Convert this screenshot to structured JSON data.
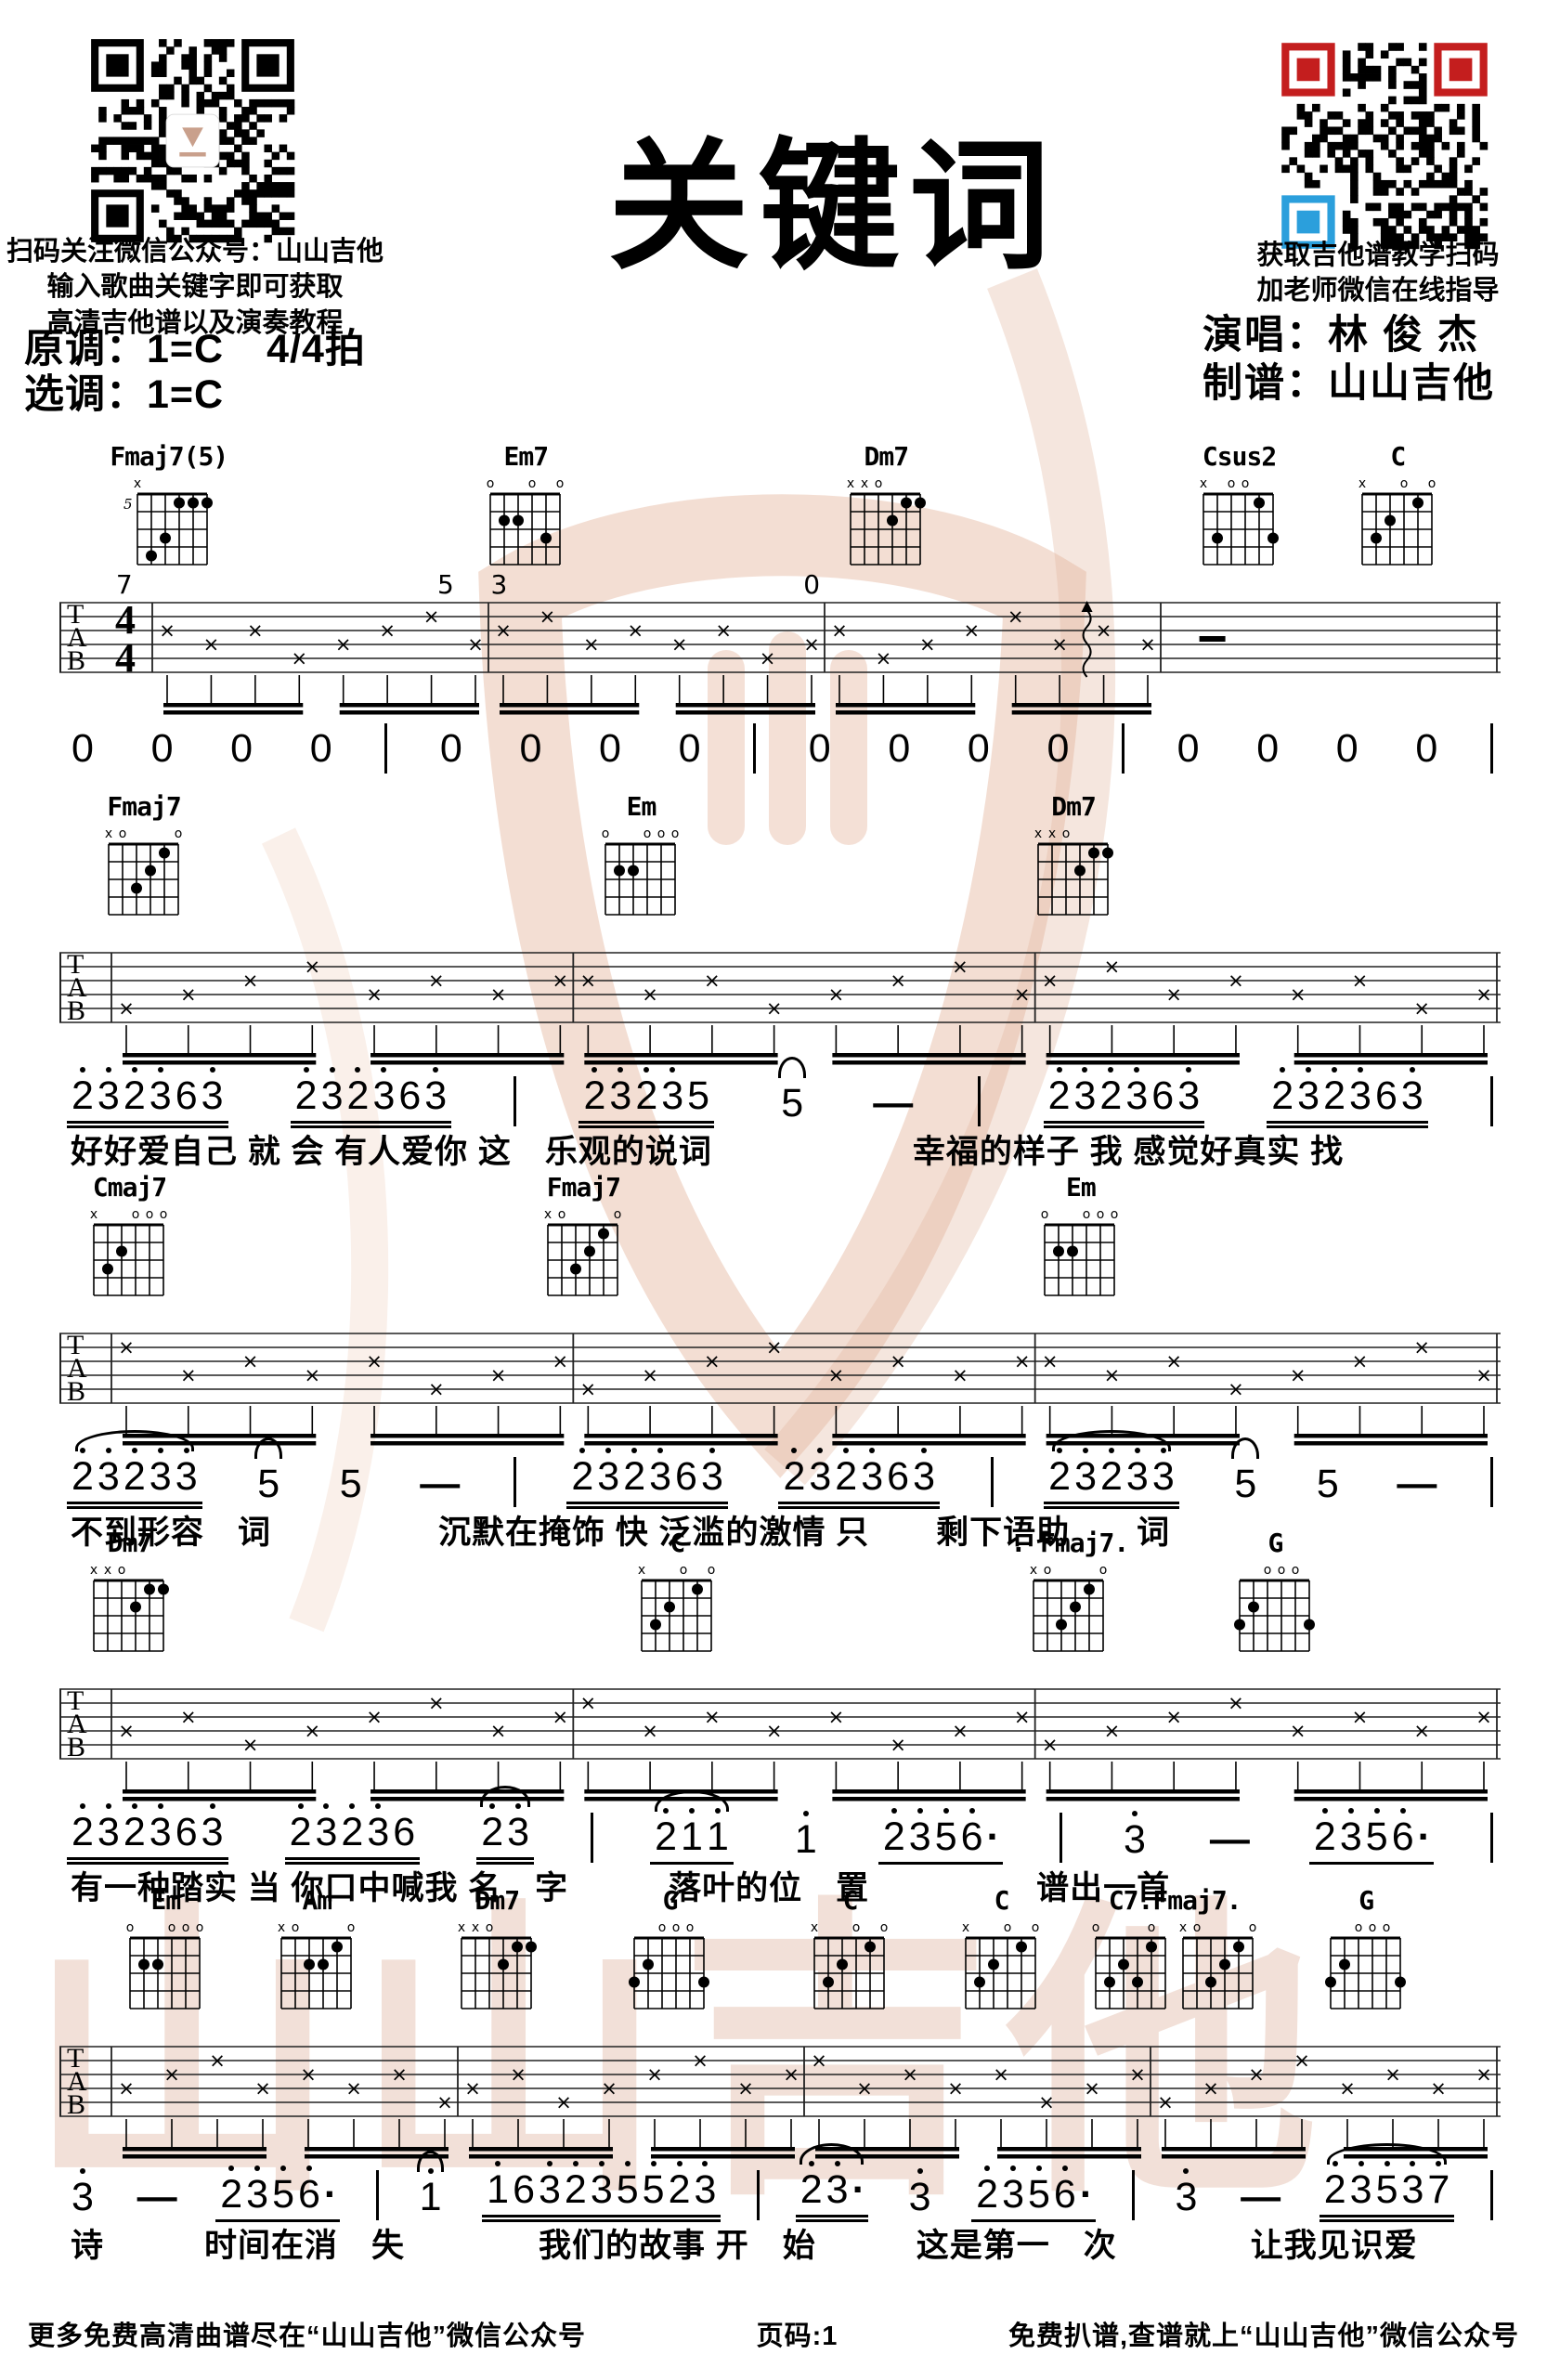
{
  "header": {
    "title": "关键词",
    "left_captions": [
      "扫码关注微信公众号：山山吉他",
      "输入歌曲关键字即可获取",
      "高清吉他谱以及演奏教程"
    ],
    "original_key": "原调：1=C",
    "time_signature_label": "4/4拍",
    "selected_key": "选调：1=C",
    "right_captions": [
      "获取吉他谱教学扫码",
      "加老师微信在线指导"
    ],
    "singer_line": "演唱：林 俊 杰",
    "transcriber_line": "制谱：山山吉他"
  },
  "tab": {
    "letters": [
      "T",
      "A",
      "B"
    ],
    "time_top": "4",
    "time_bottom": "4"
  },
  "chord_shapes": {
    "Fmaj7(5)": {
      "fret": "5",
      "markers": [
        "x",
        "",
        "",
        "",
        "",
        ""
      ],
      "dots": [
        [
          3,
          0
        ],
        [
          4,
          0
        ],
        [
          5,
          0
        ],
        [
          2,
          2
        ],
        [
          1,
          3
        ]
      ]
    },
    "Em7": {
      "markers": [
        "o",
        "",
        "",
        "o",
        "",
        "o"
      ],
      "dots": [
        [
          1,
          1
        ],
        [
          2,
          1
        ],
        [
          4,
          2
        ]
      ]
    },
    "Dm7": {
      "markers": [
        "x",
        "x",
        "o",
        "",
        "",
        ""
      ],
      "dots": [
        [
          4,
          0
        ],
        [
          5,
          0
        ],
        [
          3,
          1
        ]
      ]
    },
    "Csus2": {
      "markers": [
        "x",
        "",
        "o",
        "o",
        "",
        ""
      ],
      "dots": [
        [
          4,
          0
        ],
        [
          1,
          2
        ],
        [
          5,
          2
        ]
      ]
    },
    "C": {
      "markers": [
        "x",
        "",
        "",
        "o",
        "",
        "o"
      ],
      "dots": [
        [
          4,
          0
        ],
        [
          2,
          1
        ],
        [
          1,
          2
        ]
      ]
    },
    "Fmaj7": {
      "markers": [
        "x",
        "o",
        "",
        "",
        "",
        "o"
      ],
      "dots": [
        [
          4,
          0
        ],
        [
          3,
          1
        ],
        [
          2,
          2
        ]
      ]
    },
    "Em": {
      "markers": [
        "o",
        "",
        "",
        "o",
        "o",
        "o"
      ],
      "dots": [
        [
          1,
          1
        ],
        [
          2,
          1
        ]
      ]
    },
    "Cmaj7": {
      "markers": [
        "x",
        "",
        "",
        "o",
        "o",
        "o"
      ],
      "dots": [
        [
          2,
          1
        ],
        [
          1,
          2
        ]
      ]
    },
    "Am": {
      "markers": [
        "x",
        "o",
        "",
        "",
        "",
        "o"
      ],
      "dots": [
        [
          4,
          0
        ],
        [
          2,
          1
        ],
        [
          3,
          1
        ]
      ]
    },
    "G": {
      "markers": [
        "",
        "",
        "o",
        "o",
        "o",
        ""
      ],
      "dots": [
        [
          1,
          1
        ],
        [
          0,
          2
        ],
        [
          5,
          2
        ]
      ]
    },
    "C7": {
      "markers": [
        "o",
        "",
        "",
        "",
        "o",
        ""
      ],
      "dots": [
        [
          4,
          0
        ],
        [
          2,
          1
        ],
        [
          1,
          2
        ],
        [
          3,
          2
        ]
      ]
    }
  },
  "systems": [
    {
      "time_sig": true,
      "measures": 4,
      "chords": [
        {
          "label": "Fmaj7(5)",
          "shapes": [
            "Fmaj7(5)"
          ],
          "pos": 0.035
        },
        {
          "label": "Em7",
          "shapes": [
            "Em7"
          ],
          "pos": 0.295
        },
        {
          "label": "Dm7",
          "shapes": [
            "Dm7"
          ],
          "pos": 0.545
        },
        {
          "label": "Csus2",
          "shapes": [
            "Csus2"
          ],
          "pos": 0.79
        },
        {
          "label": "C",
          "shapes": [
            "C"
          ],
          "pos": 0.9
        }
      ],
      "tab_marks": [
        {
          "type": "num",
          "text": "7",
          "pos": 0.045
        },
        {
          "type": "num",
          "text": "5",
          "pos": 0.268
        },
        {
          "type": "num",
          "text": "3",
          "pos": 0.305
        },
        {
          "type": "num",
          "text": "0",
          "pos": 0.522
        },
        {
          "type": "strum",
          "pos": 0.713
        },
        {
          "type": "dash",
          "pos": 0.8
        }
      ],
      "notes": [
        {
          "t": "0"
        },
        {
          "t": "0"
        },
        {
          "t": "0"
        },
        {
          "t": "0"
        },
        {
          "t": "|"
        },
        {
          "t": "0"
        },
        {
          "t": "0"
        },
        {
          "t": "0"
        },
        {
          "t": "0"
        },
        {
          "t": "|"
        },
        {
          "t": "0"
        },
        {
          "t": "0"
        },
        {
          "t": "0"
        },
        {
          "t": "0"
        },
        {
          "t": "|"
        },
        {
          "t": "0"
        },
        {
          "t": "0"
        },
        {
          "t": "0"
        },
        {
          "t": "0"
        },
        {
          "t": "|"
        }
      ],
      "lyrics": ""
    },
    {
      "time_sig": false,
      "measures": 3,
      "chords": [
        {
          "label": "Fmaj7",
          "shapes": [
            "Fmaj7"
          ],
          "pos": 0.03
        },
        {
          "label": "Em",
          "shapes": [
            "Em"
          ],
          "pos": 0.375
        },
        {
          "label": "Dm7",
          "shapes": [
            "Dm7"
          ],
          "pos": 0.675
        }
      ],
      "tab_marks": [],
      "notes": [
        {
          "t": "2̇3̇2̇3̇63̇",
          "u": 2
        },
        {
          "t": "2̇3̇2̇3̇63̇",
          "u": 2
        },
        {
          "t": "|"
        },
        {
          "t": "2̇3̇2̇3̇5",
          "u": 2
        },
        {
          "t": "5",
          "tie": true
        },
        {
          "t": "—"
        },
        {
          "t": "|"
        },
        {
          "t": "2̇3̇2̇3̇63̇",
          "u": 2
        },
        {
          "t": "2̇3̇2̇3̇63̇",
          "u": 2
        },
        {
          "t": "|"
        }
      ],
      "lyrics": "好好爱自己 就 会 有人爱你 这　乐观的说词　　　　　　幸福的样子 我 感觉好真实 找"
    },
    {
      "time_sig": false,
      "measures": 3,
      "chords": [
        {
          "label": "Cmaj7",
          "shapes": [
            "Cmaj7"
          ],
          "pos": 0.02
        },
        {
          "label": "Fmaj7",
          "shapes": [
            "Fmaj7"
          ],
          "pos": 0.335
        },
        {
          "label": "Em",
          "shapes": [
            "Em"
          ],
          "pos": 0.68
        }
      ],
      "tab_marks": [],
      "notes": [
        {
          "t": "2̇3̇2̇3̇3̇",
          "u": 2,
          "tie": true
        },
        {
          "t": "5",
          "tie": true
        },
        {
          "t": "5"
        },
        {
          "t": "—"
        },
        {
          "t": "|"
        },
        {
          "t": "2̇3̇2̇3̇63̇",
          "u": 2
        },
        {
          "t": "2̇3̇2̇3̇63̇",
          "u": 2
        },
        {
          "t": "|"
        },
        {
          "t": "2̇3̇2̇3̇3̇",
          "u": 2,
          "tie": true
        },
        {
          "t": "5",
          "tie": true
        },
        {
          "t": "5"
        },
        {
          "t": "—"
        },
        {
          "t": "|"
        }
      ],
      "lyrics": "不到形容　词　　　　　沉默在掩饰 快 泛滥的激情 只　　剩下语助　　词"
    },
    {
      "time_sig": false,
      "measures": 3,
      "chords": [
        {
          "label": "Dm7",
          "shapes": [
            "Dm7"
          ],
          "pos": 0.02
        },
        {
          "label": "C",
          "shapes": [
            "C"
          ],
          "pos": 0.4
        },
        {
          "label": ". Fmaj7.",
          "shapes": [
            "Fmaj7"
          ],
          "pos": 0.66
        },
        {
          "label": "G",
          "shapes": [
            "G"
          ],
          "pos": 0.815
        }
      ],
      "tab_marks": [],
      "notes": [
        {
          "t": "2̇3̇2̇3̇63̇",
          "u": 2
        },
        {
          "t": "2̇3̇2̇3̇6",
          "u": 2
        },
        {
          "t": "2̇3̇",
          "u": 2,
          "tie": true
        },
        {
          "t": "|"
        },
        {
          "t": "2̇1̇1̇",
          "u": 1,
          "tie": true
        },
        {
          "t": "1̇"
        },
        {
          "t": "2̇3̇5̇6̇·",
          "u": 1
        },
        {
          "t": "|"
        },
        {
          "t": "3̇"
        },
        {
          "t": "—"
        },
        {
          "t": "2̇3̇5̇6̇·",
          "u": 1
        },
        {
          "t": "|"
        }
      ],
      "lyrics": "有一种踏实 当 你口中喊我 名　字　　　落叶的位　置　　　　　谱出一首"
    },
    {
      "time_sig": false,
      "measures": 4,
      "chords": [
        {
          "label": "Em",
          "shapes": [
            "Em"
          ],
          "pos": 0.045
        },
        {
          "label": "Am",
          "shapes": [
            "Am"
          ],
          "pos": 0.15
        },
        {
          "label": "Dm7",
          "shapes": [
            "Dm7"
          ],
          "pos": 0.275
        },
        {
          "label": "G",
          "shapes": [
            "G"
          ],
          "pos": 0.395
        },
        {
          "label": "C",
          "shapes": [
            "C"
          ],
          "pos": 0.52
        },
        {
          "label": "C",
          "shapes": [
            "C"
          ],
          "pos": 0.625
        },
        {
          "label": "C7.Fmaj7.",
          "shapes": [
            "C7",
            "Fmaj7"
          ],
          "pos": 0.715
        },
        {
          "label": "G",
          "shapes": [
            "G"
          ],
          "pos": 0.878
        }
      ],
      "tab_marks": [],
      "notes": [
        {
          "t": "3̇"
        },
        {
          "t": "—"
        },
        {
          "t": "2̇3̇5̇6̇·",
          "u": 1
        },
        {
          "t": "|"
        },
        {
          "t": "1̇",
          "tie": true
        },
        {
          "t": "1̇63̇2̇3̇5̇5̇2̇3̇",
          "u": 2
        },
        {
          "t": "|"
        },
        {
          "t": "2̇3̇·",
          "u": 2,
          "tie": true
        },
        {
          "t": "3̇"
        },
        {
          "t": "2̇3̇5̇6̇·",
          "u": 1
        },
        {
          "t": "|"
        },
        {
          "t": "3̇"
        },
        {
          "t": "—"
        },
        {
          "t": "2̇3̇5̇3̇7̇",
          "u": 2,
          "tie": true
        },
        {
          "t": "|"
        }
      ],
      "lyrics": "诗　　　时间在消　失　　　　我们的故事 开　始　　　这是第一　次　　　　让我见识爱"
    }
  ],
  "watermark": {
    "text": "山山吉他",
    "color": "#dfb5a1"
  },
  "footer": {
    "left": "更多免费高清曲谱尽在“山山吉他”微信公众号",
    "center": "页码:1",
    "right": "免费扒谱,查谱就上“山山吉他”微信公众号"
  },
  "colors": {
    "ink": "#000000",
    "qr_red": "#c41e1e",
    "qr_blue": "#2b9fdc",
    "watermark": "#e5bca8"
  }
}
